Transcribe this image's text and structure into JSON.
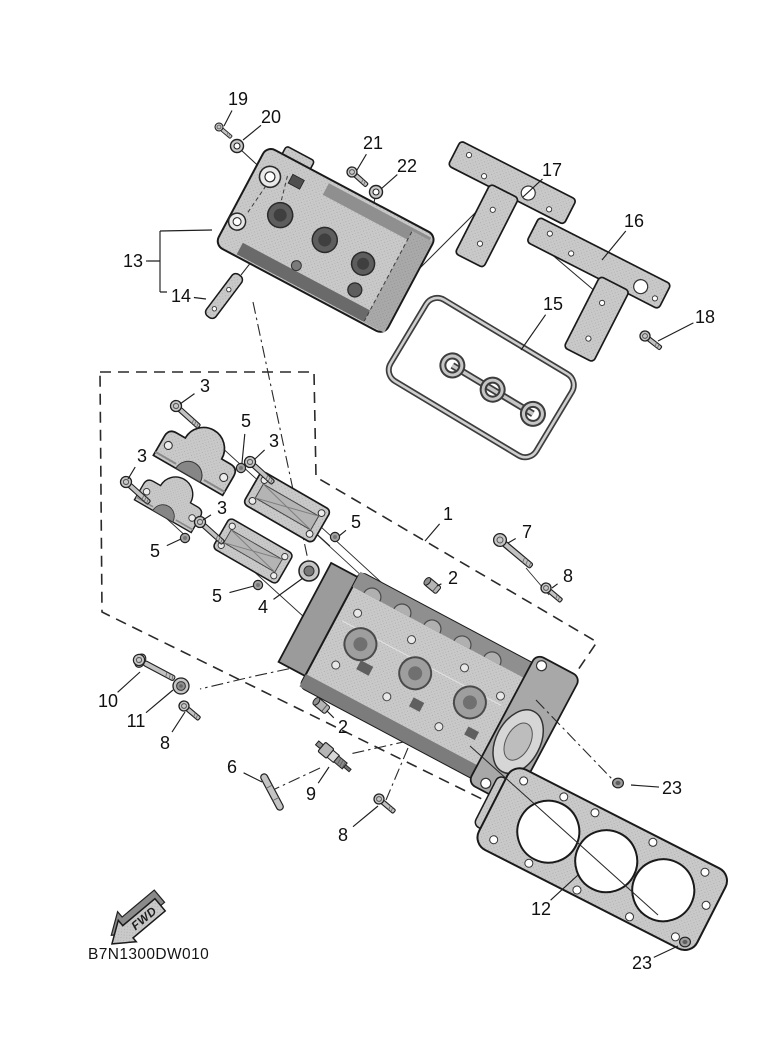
{
  "diagram": {
    "part_code": "B7N1300DW010",
    "fwd_label": "FWD",
    "colors": {
      "line": "#1a1a1a",
      "part_fill": "#c9c9c9",
      "part_shade": "#9b9b9b",
      "part_dark": "#6e6e6e",
      "background": "#ffffff"
    },
    "callouts": [
      {
        "n": "19",
        "x": 238,
        "y": 99,
        "tx": 224,
        "ty": 126
      },
      {
        "n": "20",
        "x": 271,
        "y": 117,
        "tx": 243,
        "ty": 140
      },
      {
        "n": "21",
        "x": 373,
        "y": 143,
        "tx": 357,
        "ty": 170
      },
      {
        "n": "22",
        "x": 407,
        "y": 166,
        "tx": 381,
        "ty": 189
      },
      {
        "n": "13",
        "x": 133,
        "y": 261,
        "tx": 148,
        "ty": 261
      },
      {
        "n": "14",
        "x": 181,
        "y": 296,
        "tx": 206,
        "ty": 299
      },
      {
        "n": "17",
        "x": 552,
        "y": 170,
        "tx": 523,
        "ty": 197
      },
      {
        "n": "16",
        "x": 634,
        "y": 221,
        "tx": 602,
        "ty": 260
      },
      {
        "n": "15",
        "x": 553,
        "y": 304,
        "tx": 521,
        "ty": 350
      },
      {
        "n": "18",
        "x": 705,
        "y": 317,
        "tx": 658,
        "ty": 341
      },
      {
        "n": "3",
        "x": 205,
        "y": 386,
        "tx": 180,
        "ty": 404
      },
      {
        "n": "5",
        "x": 246,
        "y": 421,
        "tx": 242,
        "ty": 463
      },
      {
        "n": "3",
        "x": 274,
        "y": 441,
        "tx": 255,
        "ty": 459
      },
      {
        "n": "3",
        "x": 142,
        "y": 456,
        "tx": 128,
        "ty": 479
      },
      {
        "n": "3",
        "x": 222,
        "y": 508,
        "tx": 203,
        "ty": 520
      },
      {
        "n": "5",
        "x": 155,
        "y": 551,
        "tx": 181,
        "ty": 539
      },
      {
        "n": "5",
        "x": 356,
        "y": 522,
        "tx": 339,
        "ty": 536
      },
      {
        "n": "5",
        "x": 217,
        "y": 596,
        "tx": 254,
        "ty": 586
      },
      {
        "n": "4",
        "x": 263,
        "y": 607,
        "tx": 303,
        "ty": 578
      },
      {
        "n": "1",
        "x": 448,
        "y": 514,
        "tx": 425,
        "ty": 541
      },
      {
        "n": "7",
        "x": 527,
        "y": 532,
        "tx": 508,
        "ty": 543
      },
      {
        "n": "2",
        "x": 453,
        "y": 578,
        "tx": 437,
        "ty": 586
      },
      {
        "n": "8",
        "x": 568,
        "y": 576,
        "tx": 552,
        "ty": 588
      },
      {
        "n": "2",
        "x": 343,
        "y": 727,
        "tx": 327,
        "ty": 711
      },
      {
        "n": "10",
        "x": 108,
        "y": 701,
        "tx": 140,
        "ty": 672
      },
      {
        "n": "11",
        "x": 136,
        "y": 721,
        "tx": 173,
        "ty": 690
      },
      {
        "n": "8",
        "x": 165,
        "y": 743,
        "tx": 185,
        "ty": 712
      },
      {
        "n": "6",
        "x": 232,
        "y": 767,
        "tx": 262,
        "ty": 782
      },
      {
        "n": "9",
        "x": 311,
        "y": 794,
        "tx": 329,
        "ty": 767
      },
      {
        "n": "8",
        "x": 343,
        "y": 835,
        "tx": 378,
        "ty": 806
      },
      {
        "n": "23",
        "x": 672,
        "y": 788,
        "tx": 631,
        "ty": 785
      },
      {
        "n": "12",
        "x": 541,
        "y": 909,
        "tx": 578,
        "ty": 875
      },
      {
        "n": "23",
        "x": 642,
        "y": 963,
        "tx": 678,
        "ty": 946
      }
    ]
  }
}
